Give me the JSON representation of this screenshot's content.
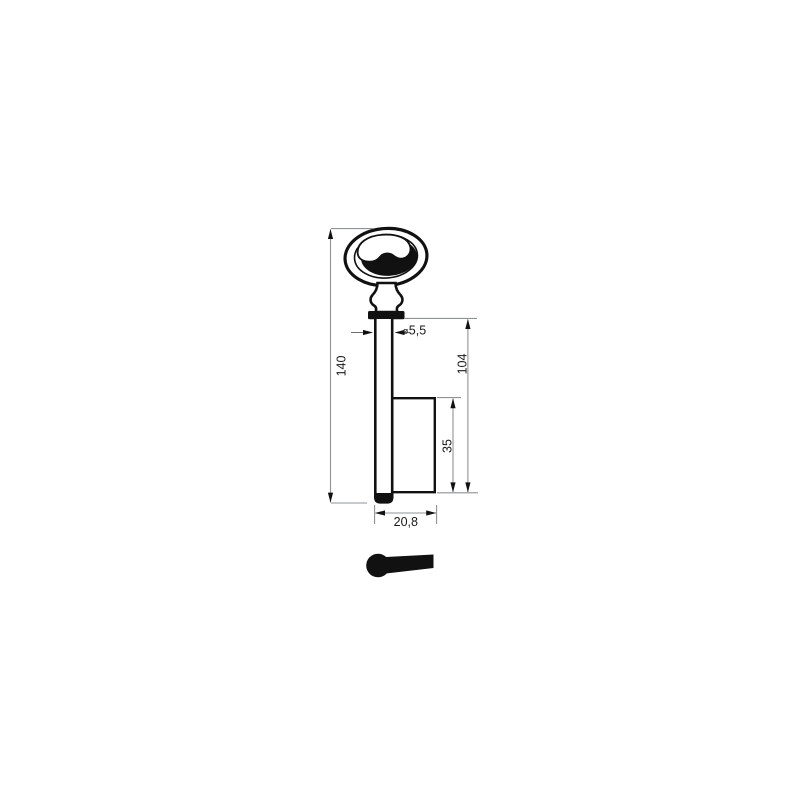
{
  "drawing": {
    "kind": "key-blank-technical-drawing",
    "views": {
      "front": "key front view with bow, neck, collar, shaft and bit",
      "profile": "key bit cross-section silhouette"
    },
    "dimensions": {
      "overall_length": "140",
      "shaft_length": "104",
      "bit_height": "35",
      "overall_width": "20,8",
      "shaft_diameter": {
        "symbol": "ø",
        "value": "5,5"
      }
    },
    "colors": {
      "outline": "#111111",
      "dimension_line": "#8f9396",
      "arrow": "#111111",
      "text": "#1a1a1a",
      "fill": "#ffffff",
      "silhouette": "#111111",
      "background": "#ffffff"
    }
  }
}
